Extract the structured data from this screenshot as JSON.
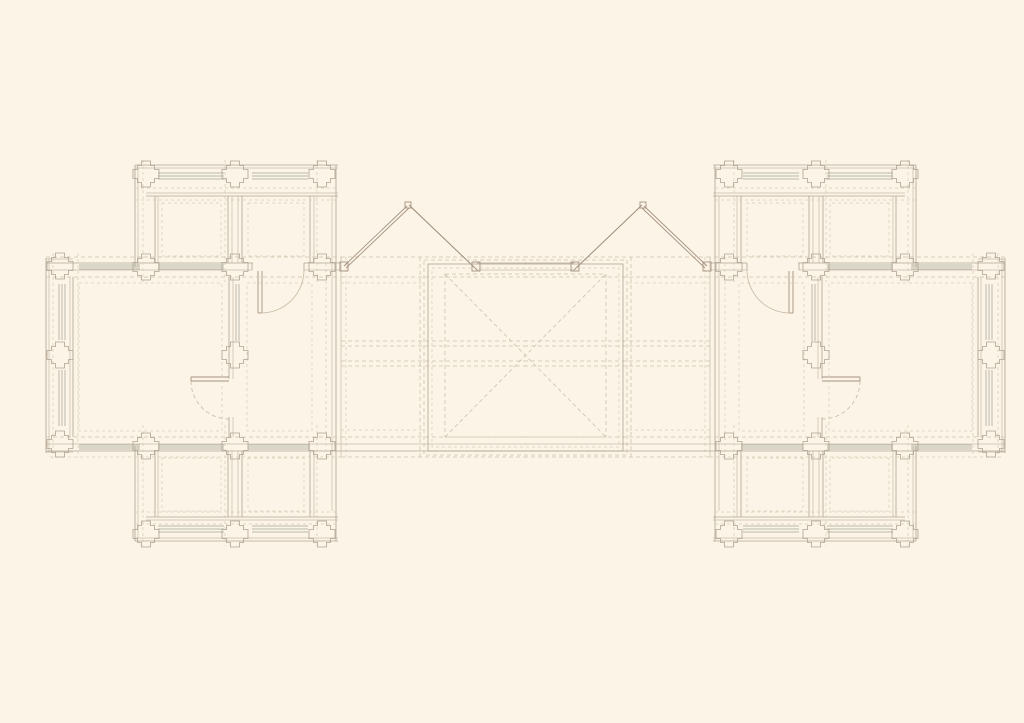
{
  "canvas": {
    "width": 1024,
    "height": 723,
    "background": "#fcf5e7"
  },
  "styles": {
    "wall": {
      "color": "#b0a494",
      "width": 0.8
    },
    "wall2": {
      "color": "#c6baa8",
      "width": 0.7
    },
    "win": {
      "color": "#a3a093",
      "width": 0.7
    },
    "dash": {
      "color": "#ccc0ab",
      "width": 0.8,
      "dash": "4 3"
    },
    "dash2": {
      "color": "#d6cab5",
      "width": 0.7,
      "dash": "3 3"
    },
    "door": {
      "color": "#a5917f",
      "width": 0.9
    },
    "arc": {
      "color": "#c8b8a4",
      "width": 0.8
    },
    "arcdash": {
      "color": "#c8b8a4",
      "width": 0.8,
      "dash": "4 3"
    }
  },
  "plan": {
    "mirror_transform": "translate(1051 0) scale(-1 1)",
    "wing": {
      "lines": [
        [
          46,
          258,
          46,
          453,
          "wall"
        ],
        [
          49,
          258,
          49,
          453,
          "wall2"
        ],
        [
          70,
          277,
          70,
          437,
          "wall2"
        ],
        [
          73,
          277,
          73,
          437,
          "wall"
        ],
        [
          46,
          259,
          73,
          259,
          "wall2"
        ],
        [
          46,
          452,
          73,
          452,
          "wall2"
        ],
        [
          46,
          263,
          253,
          263,
          "wall"
        ],
        [
          304,
          263,
          341,
          263,
          "wall"
        ],
        [
          46,
          270,
          252,
          270,
          "wall2"
        ],
        [
          304,
          270,
          341,
          270,
          "wall2"
        ],
        [
          252,
          263,
          252,
          270,
          "wall"
        ],
        [
          304,
          263,
          304,
          270,
          "wall"
        ],
        [
          79,
          265,
          140,
          265,
          "win"
        ],
        [
          79,
          267,
          140,
          267,
          "win"
        ],
        [
          79,
          269,
          140,
          269,
          "win"
        ],
        [
          158,
          265,
          224,
          265,
          "win"
        ],
        [
          158,
          267,
          224,
          267,
          "win"
        ],
        [
          158,
          269,
          224,
          269,
          "win"
        ],
        [
          46,
          444,
          341,
          444,
          "wall2"
        ],
        [
          46,
          451,
          341,
          451,
          "wall"
        ],
        [
          79,
          445,
          140,
          445,
          "win"
        ],
        [
          79,
          447,
          140,
          447,
          "win"
        ],
        [
          79,
          449,
          140,
          449,
          "win"
        ],
        [
          158,
          445,
          224,
          445,
          "win"
        ],
        [
          158,
          447,
          224,
          447,
          "win"
        ],
        [
          158,
          449,
          224,
          449,
          "win"
        ],
        [
          248,
          445,
          310,
          445,
          "win"
        ],
        [
          248,
          447,
          310,
          447,
          "win"
        ],
        [
          248,
          449,
          310,
          449,
          "win"
        ],
        [
          135,
          165,
          338,
          165,
          "wall"
        ],
        [
          135,
          168,
          338,
          168,
          "wall2"
        ],
        [
          146,
          193,
          338,
          193,
          "wall2"
        ],
        [
          146,
          196,
          338,
          196,
          "wall"
        ],
        [
          135,
          165,
          135,
          267,
          "wall"
        ],
        [
          138,
          168,
          138,
          267,
          "wall2"
        ],
        [
          158,
          173,
          224,
          173,
          "win"
        ],
        [
          158,
          176,
          224,
          176,
          "win"
        ],
        [
          158,
          179,
          224,
          179,
          "win"
        ],
        [
          252,
          173,
          308,
          173,
          "win"
        ],
        [
          252,
          176,
          308,
          176,
          "win"
        ],
        [
          252,
          179,
          308,
          179,
          "win"
        ],
        [
          155,
          196,
          155,
          263,
          "wall"
        ],
        [
          158,
          196,
          158,
          263,
          "wall2"
        ],
        [
          228,
          196,
          228,
          263,
          "wall"
        ],
        [
          232,
          196,
          232,
          263,
          "wall2"
        ],
        [
          238,
          196,
          238,
          263,
          "wall2"
        ],
        [
          242,
          196,
          242,
          263,
          "wall"
        ],
        [
          310,
          196,
          310,
          263,
          "wall"
        ],
        [
          314,
          196,
          314,
          263,
          "wall2"
        ],
        [
          336,
          165,
          336,
          541,
          "wall"
        ],
        [
          332,
          196,
          332,
          511,
          "wall2"
        ],
        [
          341,
          257,
          341,
          457,
          "wall2"
        ],
        [
          135,
          541,
          338,
          541,
          "wall"
        ],
        [
          135,
          538,
          338,
          538,
          "wall2"
        ],
        [
          146,
          517,
          338,
          517,
          "wall"
        ],
        [
          146,
          520,
          338,
          520,
          "wall2"
        ],
        [
          135,
          446,
          135,
          541,
          "wall"
        ],
        [
          138,
          446,
          138,
          538,
          "wall2"
        ],
        [
          158,
          526,
          224,
          526,
          "win"
        ],
        [
          158,
          529,
          224,
          529,
          "win"
        ],
        [
          158,
          532,
          224,
          532,
          "win"
        ],
        [
          252,
          526,
          308,
          526,
          "win"
        ],
        [
          252,
          529,
          308,
          529,
          "win"
        ],
        [
          252,
          532,
          308,
          532,
          "win"
        ],
        [
          155,
          451,
          155,
          517,
          "wall"
        ],
        [
          158,
          451,
          158,
          517,
          "wall2"
        ],
        [
          228,
          451,
          228,
          517,
          "wall"
        ],
        [
          232,
          451,
          232,
          517,
          "wall2"
        ],
        [
          238,
          451,
          238,
          517,
          "wall2"
        ],
        [
          242,
          451,
          242,
          517,
          "wall"
        ],
        [
          310,
          451,
          310,
          517,
          "wall"
        ],
        [
          314,
          451,
          314,
          517,
          "wall2"
        ],
        [
          229,
          277,
          229,
          379,
          "wall"
        ],
        [
          233,
          277,
          233,
          379,
          "wall2"
        ],
        [
          229,
          417,
          229,
          437,
          "wall"
        ],
        [
          233,
          417,
          233,
          437,
          "wall2"
        ],
        [
          236,
          284,
          236,
          341,
          "win"
        ],
        [
          239,
          284,
          239,
          341,
          "win"
        ],
        [
          59,
          284,
          59,
          340,
          "win"
        ],
        [
          62,
          284,
          62,
          340,
          "win"
        ],
        [
          65,
          284,
          65,
          340,
          "win"
        ],
        [
          59,
          370,
          59,
          426,
          "win"
        ],
        [
          62,
          370,
          62,
          426,
          "win"
        ],
        [
          65,
          370,
          65,
          426,
          "win"
        ],
        [
          258,
          271,
          258,
          313,
          "door"
        ],
        [
          262,
          271,
          262,
          313,
          "door"
        ],
        [
          258,
          313,
          262,
          313,
          "door"
        ],
        [
          191,
          377,
          229,
          377,
          "door"
        ],
        [
          191,
          381,
          229,
          381,
          "door"
        ],
        [
          191,
          377,
          191,
          381,
          "door"
        ],
        [
          341,
          257,
          526,
          257,
          "dash"
        ],
        [
          341,
          277,
          526,
          277,
          "dash"
        ],
        [
          341,
          341,
          526,
          341,
          "dash"
        ],
        [
          341,
          346,
          526,
          346,
          "dash"
        ],
        [
          341,
          361,
          526,
          361,
          "dash"
        ],
        [
          341,
          366,
          526,
          366,
          "dash"
        ],
        [
          341,
          437,
          526,
          437,
          "dash"
        ],
        [
          341,
          457,
          526,
          457,
          "dash"
        ],
        [
          341,
          283,
          424,
          283,
          "dash2"
        ],
        [
          341,
          430,
          424,
          430,
          "dash2"
        ],
        [
          420,
          257,
          420,
          457,
          "dash"
        ],
        [
          346,
          257,
          346,
          457,
          "dash2"
        ],
        [
          326,
          257,
          326,
          457,
          "dash2"
        ],
        [
          477,
          263,
          526,
          263,
          "wall"
        ],
        [
          477,
          270,
          526,
          270,
          "wall2"
        ],
        [
          341,
          444,
          526,
          444,
          "wall2"
        ],
        [
          341,
          451,
          526,
          451,
          "wall"
        ],
        [
          135,
          188,
          338,
          188,
          "dash2"
        ],
        [
          135,
          200,
          338,
          200,
          "dash2"
        ],
        [
          135,
          512,
          338,
          512,
          "dash2"
        ],
        [
          135,
          524,
          338,
          524,
          "dash2"
        ],
        [
          143,
          160,
          143,
          282,
          "dash2"
        ],
        [
          225,
          160,
          225,
          282,
          "dash2"
        ],
        [
          317,
          160,
          317,
          282,
          "dash2"
        ],
        [
          143,
          425,
          143,
          546,
          "dash2"
        ],
        [
          225,
          425,
          225,
          546,
          "dash2"
        ],
        [
          317,
          425,
          317,
          546,
          "dash2"
        ],
        [
          46,
          257,
          341,
          257,
          "dash"
        ],
        [
          46,
          277,
          341,
          277,
          "dash"
        ],
        [
          46,
          437,
          341,
          437,
          "dash"
        ],
        [
          50,
          457,
          341,
          457,
          "dash2"
        ],
        [
          53,
          253,
          53,
          458,
          "dash2"
        ],
        [
          78,
          253,
          78,
          458,
          "dash2"
        ],
        [
          344,
          266,
          407,
          206,
          "door"
        ],
        [
          346,
          268,
          409,
          208,
          "door"
        ],
        [
          475,
          268,
          409,
          205,
          "door"
        ],
        [
          477,
          270,
          411,
          207,
          "door"
        ]
      ],
      "rects": [
        [
          162,
          203,
          59,
          53,
          "dash2"
        ],
        [
          248,
          203,
          56,
          53,
          "dash2"
        ],
        [
          162,
          458,
          59,
          53,
          "dash2"
        ],
        [
          248,
          458,
          56,
          53,
          "dash2"
        ],
        [
          79,
          283,
          143,
          148,
          "dash2"
        ],
        [
          247,
          283,
          65,
          148,
          "dash2"
        ],
        [
          340,
          262,
          8,
          9,
          "door"
        ],
        [
          472,
          262,
          8,
          9,
          "door"
        ],
        [
          405,
          202,
          6,
          6,
          "door"
        ]
      ],
      "piers": [
        [
          60,
          266
        ],
        [
          60,
          355
        ],
        [
          60,
          444
        ],
        [
          146,
          174
        ],
        [
          235,
          174
        ],
        [
          322,
          174
        ],
        [
          146,
          267
        ],
        [
          235,
          267
        ],
        [
          322,
          267
        ],
        [
          235,
          355
        ],
        [
          146,
          446
        ],
        [
          235,
          446
        ],
        [
          322,
          446
        ],
        [
          146,
          534
        ],
        [
          235,
          534
        ],
        [
          322,
          534
        ]
      ],
      "paths": [
        [
          "M261,313 A43,43 0 0 0 304,270",
          "arc"
        ],
        [
          "M191,381 A38,38 0 0 0 229,419",
          "arcdash"
        ]
      ]
    },
    "center": {
      "rects": [
        [
          428,
          264,
          195,
          187,
          "wall"
        ],
        [
          424,
          260,
          203,
          195,
          "dash"
        ],
        [
          432,
          268,
          187,
          179,
          "dash2"
        ],
        [
          445,
          274,
          161,
          163,
          "dash"
        ]
      ],
      "lines": [
        [
          445,
          274,
          606,
          437,
          "dash"
        ],
        [
          445,
          437,
          606,
          274,
          "dash"
        ]
      ],
      "piers": [],
      "paths": []
    }
  }
}
